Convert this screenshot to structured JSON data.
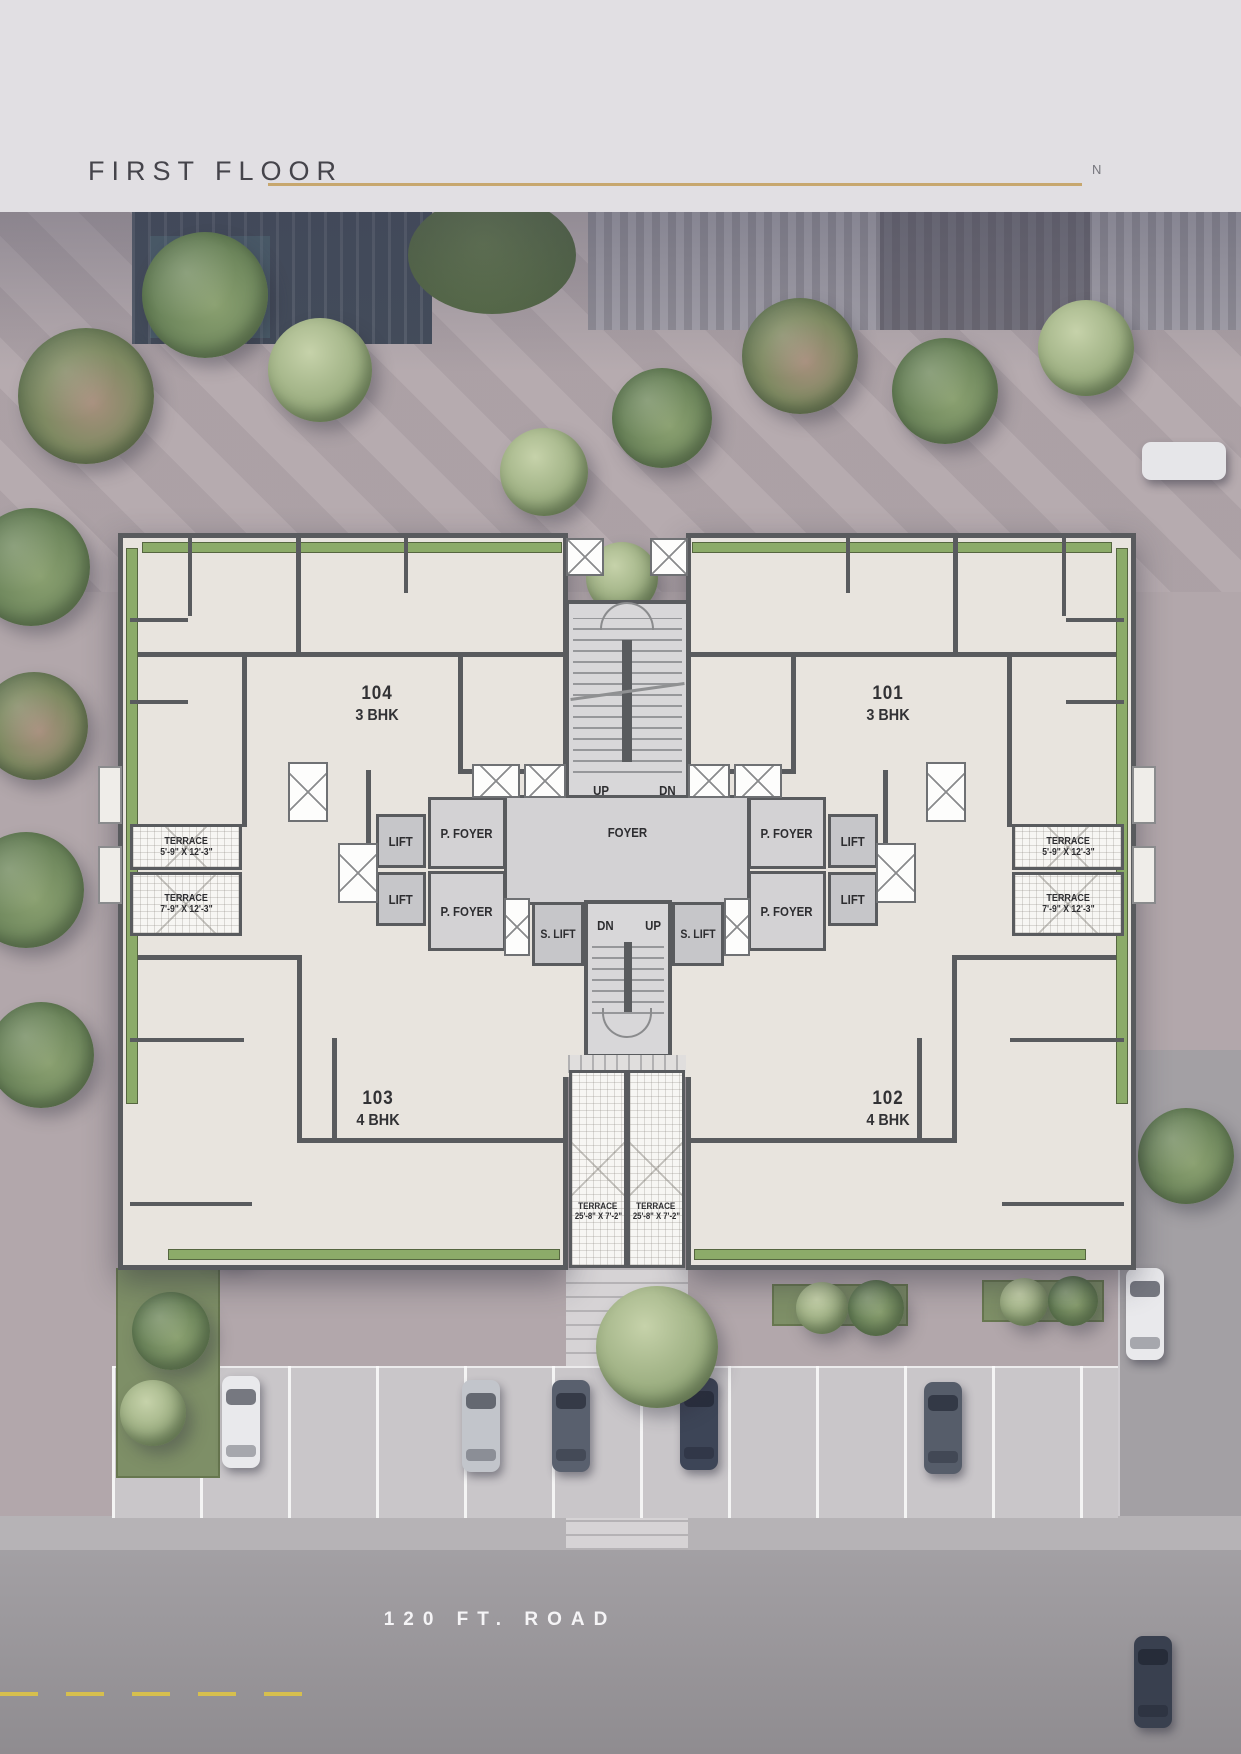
{
  "header": {
    "title": "FIRST FLOOR",
    "compass": "N"
  },
  "plan": {
    "units": [
      {
        "number": "104",
        "type": "3 BHK"
      },
      {
        "number": "101",
        "type": "3 BHK"
      },
      {
        "number": "103",
        "type": "4 BHK"
      },
      {
        "number": "102",
        "type": "4 BHK"
      }
    ],
    "labels": {
      "foyer": "FOYER",
      "p_foyer": "P. FOYER",
      "lift": "LIFT",
      "s_lift": "S. LIFT",
      "up": "UP",
      "dn": "DN"
    },
    "terraces": [
      {
        "name": "TERRACE",
        "dims": "5'-9\" X 12'-3\""
      },
      {
        "name": "TERRACE",
        "dims": "7'-9\" X 12'-3\""
      },
      {
        "name": "TERRACE",
        "dims": "5'-9\" X 12'-3\""
      },
      {
        "name": "TERRACE",
        "dims": "7'-9\" X 12'-3\""
      },
      {
        "name": "TERRACE",
        "dims": "25'-8\" X 7'-2\""
      },
      {
        "name": "TERRACE",
        "dims": "25'-8\" X 7'-2\""
      }
    ]
  },
  "road": {
    "label": "120 FT. ROAD"
  },
  "colors": {
    "accent_line": "#c7a76e",
    "plan_green": "#8cab69",
    "wall": "#595b5e",
    "room": "#e8e4de"
  }
}
